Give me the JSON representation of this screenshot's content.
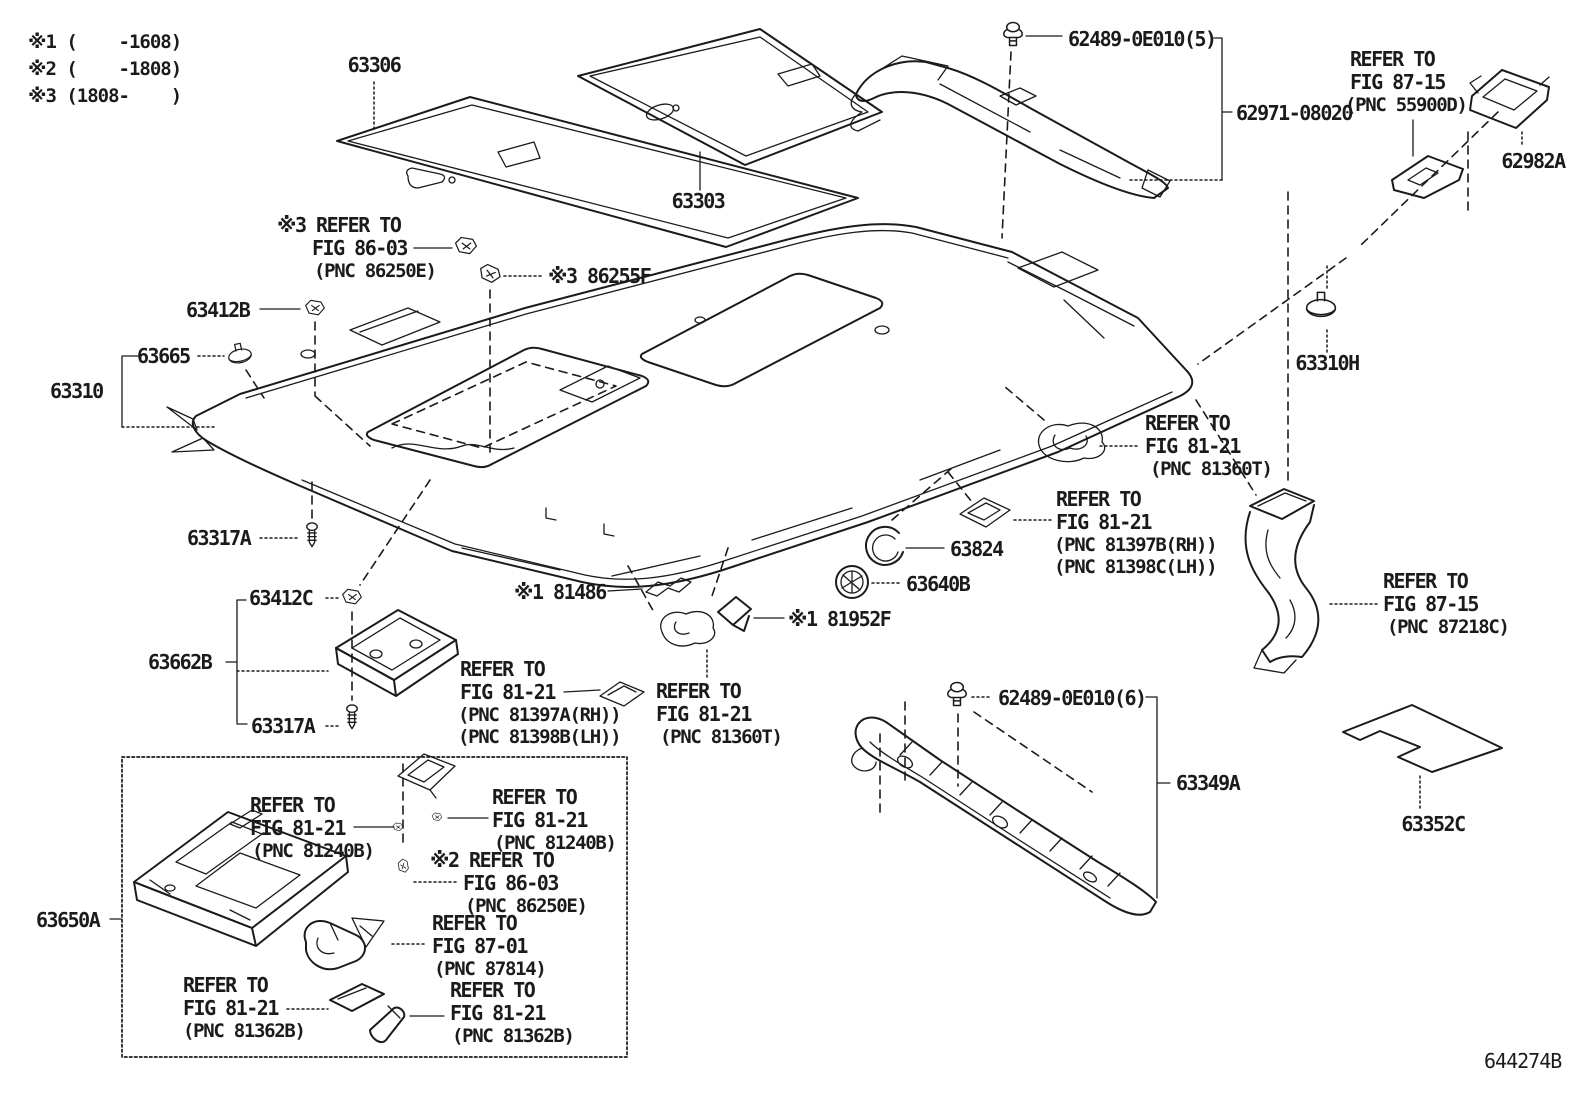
{
  "colors": {
    "ink": "#1b1b1b",
    "background": "#ffffff"
  },
  "notes": [
    "※1 (    -1608)",
    "※2 (    -1808)",
    "※3 (1808-    )"
  ],
  "labels": {
    "p63306": "63306",
    "p63303": "63303",
    "p62489_5": "62489-0E010(5)",
    "p62971": "62971-08020",
    "p62982A": "62982A",
    "p86255F": "※3 86255F",
    "p63412B": "63412B",
    "p63665": "63665",
    "p63310": "63310",
    "p63310H": "63310H",
    "p63317A_1": "63317A",
    "p63412C": "63412C",
    "p63662B": "63662B",
    "p63317A_2": "63317A",
    "p81486": "※1 81486",
    "p81952F": "※1 81952F",
    "p63824": "63824",
    "p63640B": "63640B",
    "p62489_6": "62489-0E010(6)",
    "p63349A": "63349A",
    "p63352C": "63352C",
    "p63650A": "63650A",
    "code": "644274B"
  },
  "refs": {
    "fig8715_top": {
      "l1": "REFER TO",
      "l2": "FIG 87-15",
      "l3": "(PNC 55900D)"
    },
    "fig8603_top": {
      "l1": "※3 REFER TO",
      "l2": "FIG 86-03",
      "l3": "(PNC 86250E)"
    },
    "fig8121_right_upper": {
      "l1": "REFER TO",
      "l2": "FIG 81-21",
      "l3": "(PNC 81360T)"
    },
    "fig8121_right_lower": {
      "l1": "REFER TO",
      "l2": "FIG 81-21",
      "l3": "(PNC 81397B(RH))",
      "l4": "(PNC 81398C(LH))"
    },
    "fig8121_mid_left": {
      "l1": "REFER TO",
      "l2": "FIG 81-21",
      "l3": "(PNC 81397A(RH))",
      "l4": "(PNC 81398B(LH))"
    },
    "fig8121_mid_right": {
      "l1": "REFER TO",
      "l2": "FIG 81-21",
      "l3": "(PNC 81360T)"
    },
    "fig8715_duct": {
      "l1": "REFER TO",
      "l2": "FIG 87-15",
      "l3": "(PNC 87218C)"
    },
    "fig8121_box_left": {
      "l1": "REFER TO",
      "l2": "FIG 81-21",
      "l3": "(PNC 81240B)"
    },
    "fig8121_box_right": {
      "l1": "REFER TO",
      "l2": "FIG 81-21",
      "l3": "(PNC 81240B)"
    },
    "fig8603_box": {
      "l1": "※2 REFER TO",
      "l2": "FIG 86-03",
      "l3": "(PNC 86250E)"
    },
    "fig8701_box": {
      "l1": "REFER TO",
      "l2": "FIG 87-01",
      "l3": "(PNC 87814)"
    },
    "fig8121_box_bl": {
      "l1": "REFER TO",
      "l2": "FIG 81-21",
      "l3": "(PNC 81362B)"
    },
    "fig8121_box_br": {
      "l1": "REFER TO",
      "l2": "FIG 81-21",
      "l3": "(PNC 81362B)"
    }
  }
}
